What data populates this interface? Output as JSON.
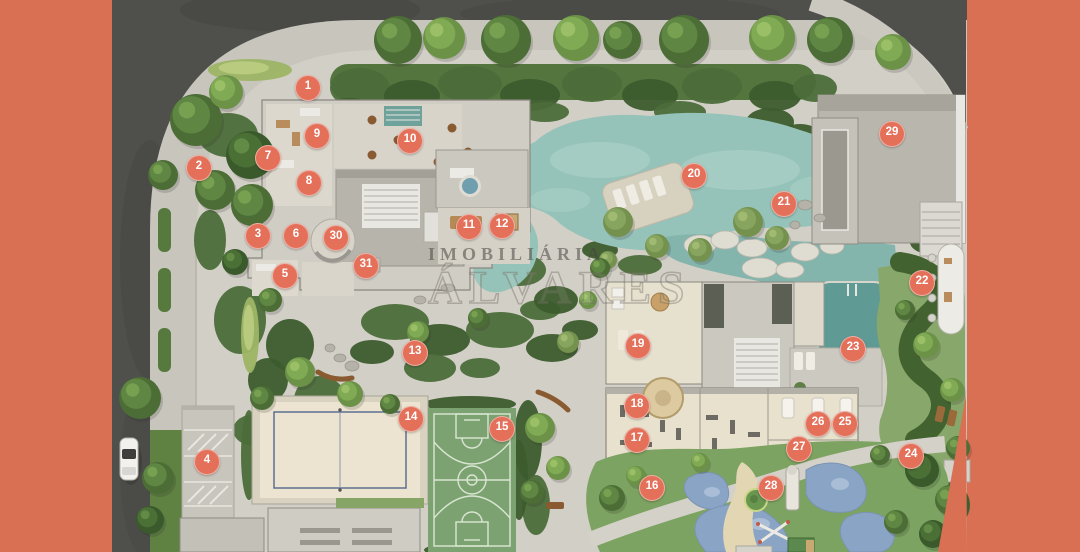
{
  "scene": {
    "description": "Aerial top-down masterplan rendering of a residential condominium with gardens, lagoon pool, sports courts, playground and numbered amenity markers",
    "trees": [
      [
        398,
        40,
        24,
        1
      ],
      [
        444,
        38,
        21,
        2
      ],
      [
        506,
        40,
        25,
        1
      ],
      [
        576,
        38,
        23,
        2
      ],
      [
        622,
        40,
        19,
        1
      ],
      [
        684,
        40,
        25,
        1
      ],
      [
        772,
        38,
        23,
        2
      ],
      [
        830,
        40,
        23,
        1
      ],
      [
        893,
        52,
        18,
        2
      ],
      [
        196,
        120,
        26,
        1
      ],
      [
        226,
        92,
        17,
        2
      ],
      [
        163,
        175,
        15,
        1
      ],
      [
        250,
        155,
        24,
        0
      ],
      [
        215,
        190,
        20,
        1
      ],
      [
        252,
        205,
        21,
        1
      ],
      [
        140,
        398,
        21,
        1
      ],
      [
        158,
        478,
        16,
        1
      ],
      [
        150,
        520,
        14,
        0
      ],
      [
        235,
        262,
        13,
        0
      ],
      [
        270,
        300,
        12,
        1
      ],
      [
        300,
        372,
        15,
        2
      ],
      [
        262,
        398,
        12,
        1
      ],
      [
        618,
        222,
        15,
        3
      ],
      [
        657,
        246,
        12,
        3
      ],
      [
        700,
        250,
        12,
        3
      ],
      [
        748,
        222,
        15,
        3
      ],
      [
        777,
        238,
        12,
        3
      ],
      [
        608,
        260,
        9,
        3
      ],
      [
        926,
        345,
        13,
        2
      ],
      [
        952,
        390,
        12,
        2
      ],
      [
        905,
        310,
        10,
        1
      ],
      [
        922,
        470,
        17,
        0
      ],
      [
        950,
        500,
        15,
        1
      ],
      [
        933,
        534,
        14,
        0
      ],
      [
        896,
        522,
        12,
        1
      ],
      [
        958,
        448,
        12,
        1
      ],
      [
        540,
        428,
        15,
        2
      ],
      [
        558,
        468,
        12,
        2
      ],
      [
        532,
        492,
        12,
        1
      ],
      [
        418,
        332,
        11,
        2
      ],
      [
        478,
        318,
        10,
        1
      ],
      [
        350,
        394,
        13,
        2
      ],
      [
        390,
        404,
        10,
        1
      ],
      [
        568,
        342,
        11,
        3
      ],
      [
        612,
        498,
        13,
        1
      ],
      [
        636,
        476,
        10,
        2
      ],
      [
        700,
        462,
        9,
        2
      ],
      [
        880,
        455,
        10,
        1
      ],
      [
        600,
        268,
        10,
        1
      ],
      [
        588,
        300,
        9,
        2
      ]
    ],
    "hedges": [
      [
        360,
        88,
        30,
        20,
        1
      ],
      [
        412,
        96,
        28,
        16,
        0
      ],
      [
        470,
        84,
        32,
        18,
        1
      ],
      [
        530,
        95,
        30,
        16,
        0
      ],
      [
        592,
        84,
        30,
        18,
        1
      ],
      [
        650,
        95,
        28,
        16,
        0
      ],
      [
        712,
        86,
        30,
        18,
        1
      ],
      [
        775,
        96,
        26,
        15,
        0
      ],
      [
        815,
        88,
        22,
        14,
        1
      ],
      [
        350,
        110,
        26,
        12,
        0
      ],
      [
        545,
        112,
        24,
        10,
        1
      ],
      [
        680,
        112,
        26,
        11,
        1
      ],
      [
        250,
        70,
        42,
        11,
        2
      ],
      [
        228,
        135,
        30,
        22,
        1
      ],
      [
        210,
        240,
        16,
        30,
        1
      ],
      [
        240,
        320,
        26,
        34,
        1
      ],
      [
        290,
        345,
        24,
        26,
        0
      ],
      [
        320,
        400,
        26,
        24,
        1
      ],
      [
        268,
        380,
        20,
        22,
        0
      ],
      [
        255,
        430,
        22,
        16,
        1
      ],
      [
        250,
        335,
        9,
        38,
        2
      ],
      [
        395,
        322,
        34,
        18,
        1
      ],
      [
        440,
        340,
        30,
        16,
        0
      ],
      [
        500,
        330,
        34,
        18,
        1
      ],
      [
        552,
        348,
        26,
        14,
        0
      ],
      [
        430,
        368,
        26,
        14,
        1
      ],
      [
        372,
        352,
        22,
        12,
        0
      ],
      [
        480,
        368,
        20,
        10,
        1
      ],
      [
        540,
        310,
        20,
        10,
        1
      ],
      [
        580,
        330,
        18,
        10,
        0
      ],
      [
        520,
        270,
        26,
        16,
        1
      ],
      [
        556,
        300,
        22,
        14,
        0
      ],
      [
        482,
        252,
        20,
        12,
        1
      ],
      [
        640,
        265,
        22,
        10,
        1
      ],
      [
        600,
        250,
        18,
        9,
        0
      ],
      [
        528,
        440,
        14,
        40,
        0
      ],
      [
        536,
        505,
        14,
        30,
        1
      ],
      [
        249,
        455,
        8,
        45,
        1
      ],
      [
        640,
        515,
        20,
        12,
        0
      ],
      [
        610,
        532,
        18,
        10,
        1
      ],
      [
        688,
        448,
        16,
        8,
        1
      ],
      [
        930,
        505,
        40,
        30,
        0
      ],
      [
        800,
        150,
        30,
        26,
        0
      ],
      [
        832,
        178,
        20,
        16,
        0
      ],
      [
        770,
        122,
        24,
        14,
        0
      ],
      [
        900,
        225,
        26,
        16,
        1
      ],
      [
        930,
        242,
        20,
        12,
        0
      ],
      [
        868,
        252,
        16,
        10,
        1
      ],
      [
        470,
        404,
        46,
        8,
        0
      ],
      [
        470,
        550,
        46,
        8,
        0
      ],
      [
        519,
        480,
        9,
        40,
        0
      ]
    ]
  },
  "watermark": {
    "line1": "IMOBILIÁRIA",
    "line2": "ÁLVARES"
  },
  "markers": {
    "style": {
      "background": "#e4705a",
      "text_color": "#ffffff"
    },
    "items": [
      {
        "n": "1",
        "x": 308,
        "y": 88
      },
      {
        "n": "2",
        "x": 199,
        "y": 168
      },
      {
        "n": "3",
        "x": 258,
        "y": 236
      },
      {
        "n": "4",
        "x": 207,
        "y": 462
      },
      {
        "n": "5",
        "x": 285,
        "y": 276
      },
      {
        "n": "6",
        "x": 296,
        "y": 236
      },
      {
        "n": "7",
        "x": 268,
        "y": 158
      },
      {
        "n": "8",
        "x": 309,
        "y": 183
      },
      {
        "n": "9",
        "x": 317,
        "y": 136
      },
      {
        "n": "10",
        "x": 410,
        "y": 141
      },
      {
        "n": "11",
        "x": 469,
        "y": 227
      },
      {
        "n": "12",
        "x": 502,
        "y": 226
      },
      {
        "n": "13",
        "x": 415,
        "y": 353
      },
      {
        "n": "14",
        "x": 411,
        "y": 419
      },
      {
        "n": "15",
        "x": 502,
        "y": 429
      },
      {
        "n": "16",
        "x": 652,
        "y": 488
      },
      {
        "n": "17",
        "x": 637,
        "y": 440
      },
      {
        "n": "18",
        "x": 637,
        "y": 406
      },
      {
        "n": "19",
        "x": 638,
        "y": 346
      },
      {
        "n": "20",
        "x": 694,
        "y": 176
      },
      {
        "n": "21",
        "x": 784,
        "y": 204
      },
      {
        "n": "22",
        "x": 922,
        "y": 283
      },
      {
        "n": "23",
        "x": 853,
        "y": 349
      },
      {
        "n": "24",
        "x": 911,
        "y": 456
      },
      {
        "n": "25",
        "x": 845,
        "y": 424
      },
      {
        "n": "26",
        "x": 818,
        "y": 424
      },
      {
        "n": "27",
        "x": 799,
        "y": 449
      },
      {
        "n": "28",
        "x": 771,
        "y": 488
      },
      {
        "n": "29",
        "x": 892,
        "y": 134
      },
      {
        "n": "30",
        "x": 336,
        "y": 238
      },
      {
        "n": "31",
        "x": 366,
        "y": 266
      }
    ]
  },
  "palette": {
    "frame_salmon": "#d96f53",
    "road_asphalt": "#4f4f4b",
    "sidewalk": "#c8c5bd",
    "site_paving": "#d2cfc7",
    "roof_gray": "#b9b6ae",
    "interior_beige": "#e8e1cd",
    "lagoon_pool": "#96c3b9",
    "lap_pool": "#5f9a95",
    "lawn_green": "#7ca361",
    "hedge_dark": "#3c5c2d",
    "sand_court": "#ece4d0",
    "basketball_court": "#7da272",
    "playground_blue": "#8aa4c6",
    "playground_sand": "#e3d6b2"
  }
}
